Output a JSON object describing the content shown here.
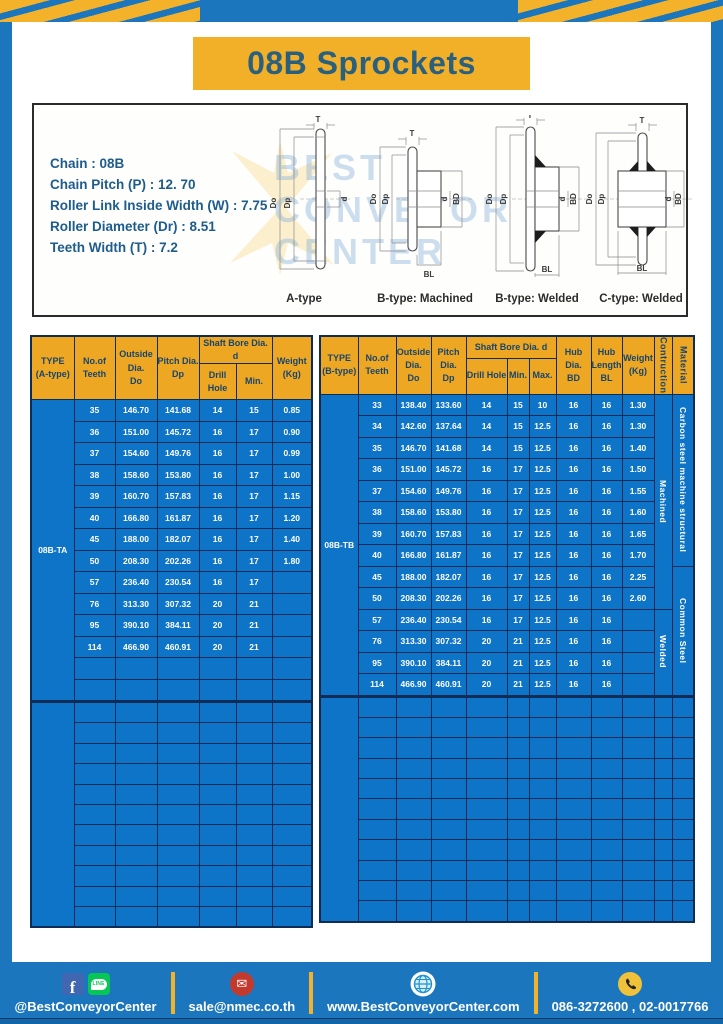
{
  "banner": {
    "title": "08B Sprockets"
  },
  "specs": {
    "lines": [
      "Chain  : 08B",
      "Chain Pitch (P)  :  12. 70",
      "Roller Link Inside Width (W)  :  7.75",
      "Roller Diameter (Dr)  : 8.51",
      "Teeth Width (T)  :  7.2"
    ]
  },
  "watermark": {
    "lines": [
      "BEST",
      "CONVEYOR",
      "CENTER"
    ]
  },
  "diagrams": [
    {
      "caption": "A-type",
      "labels": {
        "t": "T",
        "do": "Do",
        "dp": "Dp",
        "d": "d"
      }
    },
    {
      "caption": "B-type: Machined",
      "labels": {
        "t": "T",
        "do": "Do",
        "dp": "Dp",
        "d": "d",
        "bd": "BD",
        "bl": "BL"
      }
    },
    {
      "caption": "B-type: Welded",
      "labels": {
        "t": "T",
        "do": "Do",
        "dp": "Dp",
        "d": "d",
        "bd": "BD",
        "bl": "BL"
      }
    },
    {
      "caption": "C-type: Welded",
      "labels": {
        "t": "T",
        "do": "Do",
        "dp": "Dp",
        "d": "d",
        "bd": "BD",
        "bl": "BL"
      }
    }
  ],
  "table_a": {
    "headers": {
      "type": "TYPE\n(A-type)",
      "teeth": "No.of\nTeeth",
      "outside": "Outside\nDia.\nDo",
      "pitch": "Pitch Dia.\nDp",
      "shaft_bore": "Shaft Bore Dia. d",
      "drill": "Drill Hole",
      "min": "Min.",
      "weight": "Weight\n(Kg)"
    },
    "type_label": "08B-TA",
    "cols": 6,
    "section1_rows": 14,
    "section2_rows": 11,
    "rows": [
      [
        "35",
        "146.70",
        "141.68",
        "14",
        "15",
        "0.85"
      ],
      [
        "36",
        "151.00",
        "145.72",
        "16",
        "17",
        "0.90"
      ],
      [
        "37",
        "154.60",
        "149.76",
        "16",
        "17",
        "0.99"
      ],
      [
        "38",
        "158.60",
        "153.80",
        "16",
        "17",
        "1.00"
      ],
      [
        "39",
        "160.70",
        "157.83",
        "16",
        "17",
        "1.15"
      ],
      [
        "40",
        "166.80",
        "161.87",
        "16",
        "17",
        "1.20"
      ],
      [
        "45",
        "188.00",
        "182.07",
        "16",
        "17",
        "1.40"
      ],
      [
        "50",
        "208.30",
        "202.26",
        "16",
        "17",
        "1.80"
      ],
      [
        "57",
        "236.40",
        "230.54",
        "16",
        "17",
        ""
      ],
      [
        "76",
        "313.30",
        "307.32",
        "20",
        "21",
        ""
      ],
      [
        "95",
        "390.10",
        "384.11",
        "20",
        "21",
        ""
      ],
      [
        "114",
        "466.90",
        "460.91",
        "20",
        "21",
        ""
      ]
    ]
  },
  "table_b": {
    "headers": {
      "type": "TYPE\n(B-type)",
      "teeth": "No.of\nTeeth",
      "outside": "Outside\nDia.\nDo",
      "pitch": "Pitch Dia.\nDp",
      "shaft_bore": "Shaft Bore Dia. d",
      "drill": "Drill Hole",
      "min": "Min.",
      "max": "Max.",
      "hub_dia": "Hub Dia.\nBD",
      "hub_length": "Hub\nLength\nBL",
      "weight": "Weight\n(Kg)",
      "construction": "Contruction",
      "material": "Material"
    },
    "type_label": "08B-TB",
    "cols": 9,
    "extra_cols": 2,
    "section1_rows": 14,
    "section2_rows": 11,
    "rows": [
      [
        "33",
        "138.40",
        "133.60",
        "14",
        "15",
        "10",
        "16",
        "16",
        "1.30"
      ],
      [
        "34",
        "142.60",
        "137.64",
        "14",
        "15",
        "12.5",
        "16",
        "16",
        "1.30"
      ],
      [
        "35",
        "146.70",
        "141.68",
        "14",
        "15",
        "12.5",
        "16",
        "16",
        "1.40"
      ],
      [
        "36",
        "151.00",
        "145.72",
        "16",
        "17",
        "12.5",
        "16",
        "16",
        "1.50"
      ],
      [
        "37",
        "154.60",
        "149.76",
        "16",
        "17",
        "12.5",
        "16",
        "16",
        "1.55"
      ],
      [
        "38",
        "158.60",
        "153.80",
        "16",
        "17",
        "12.5",
        "16",
        "16",
        "1.60"
      ],
      [
        "39",
        "160.70",
        "157.83",
        "16",
        "17",
        "12.5",
        "16",
        "16",
        "1.65"
      ],
      [
        "40",
        "166.80",
        "161.87",
        "16",
        "17",
        "12.5",
        "16",
        "16",
        "1.70"
      ],
      [
        "45",
        "188.00",
        "182.07",
        "16",
        "17",
        "12.5",
        "16",
        "16",
        "2.25"
      ],
      [
        "50",
        "208.30",
        "202.26",
        "16",
        "17",
        "12.5",
        "16",
        "16",
        "2.60"
      ],
      [
        "57",
        "236.40",
        "230.54",
        "16",
        "17",
        "12.5",
        "16",
        "16",
        ""
      ],
      [
        "76",
        "313.30",
        "307.32",
        "20",
        "21",
        "12.5",
        "16",
        "16",
        ""
      ],
      [
        "95",
        "390.10",
        "384.11",
        "20",
        "21",
        "12.5",
        "16",
        "16",
        ""
      ],
      [
        "114",
        "466.90",
        "460.91",
        "20",
        "21",
        "12.5",
        "16",
        "16",
        ""
      ]
    ],
    "construction_spans": [
      {
        "label": "Machined",
        "start": 0,
        "span": 10
      },
      {
        "label": "Welded",
        "start": 10,
        "span": 4
      }
    ],
    "material_spans": [
      {
        "label": "Carbon steel  machine structural",
        "start": 0,
        "span": 8
      },
      {
        "label": "Common  Steel",
        "start": 8,
        "span": 6
      }
    ]
  },
  "footer": {
    "sections": [
      {
        "icons": [
          "facebook-icon",
          "line-icon"
        ],
        "text": "@BestConveyorCenter"
      },
      {
        "icons": [
          "email-icon"
        ],
        "text": "sale@nmec.co.th"
      },
      {
        "icons": [
          "globe-icon"
        ],
        "text": "www.BestConveyorCenter.com"
      },
      {
        "icons": [
          "phone-icon"
        ],
        "text": "086-3272600 , 02-0017766"
      }
    ]
  },
  "colors": {
    "frame_blue": "#1b76bd",
    "stripe_yellow": "#f3b229",
    "banner_yellow": "#f2b029",
    "table_header_yellow": "#eea722",
    "table_body_blue": "#0e74c8",
    "table_border_navy": "#0e2c55",
    "title_ink": "#2a607e",
    "spec_ink": "#1d5c8c",
    "facebook_blue": "#4267B2",
    "line_green": "#06C755",
    "mail_red": "#c23a2e",
    "phone_yellow": "#f0c239"
  }
}
